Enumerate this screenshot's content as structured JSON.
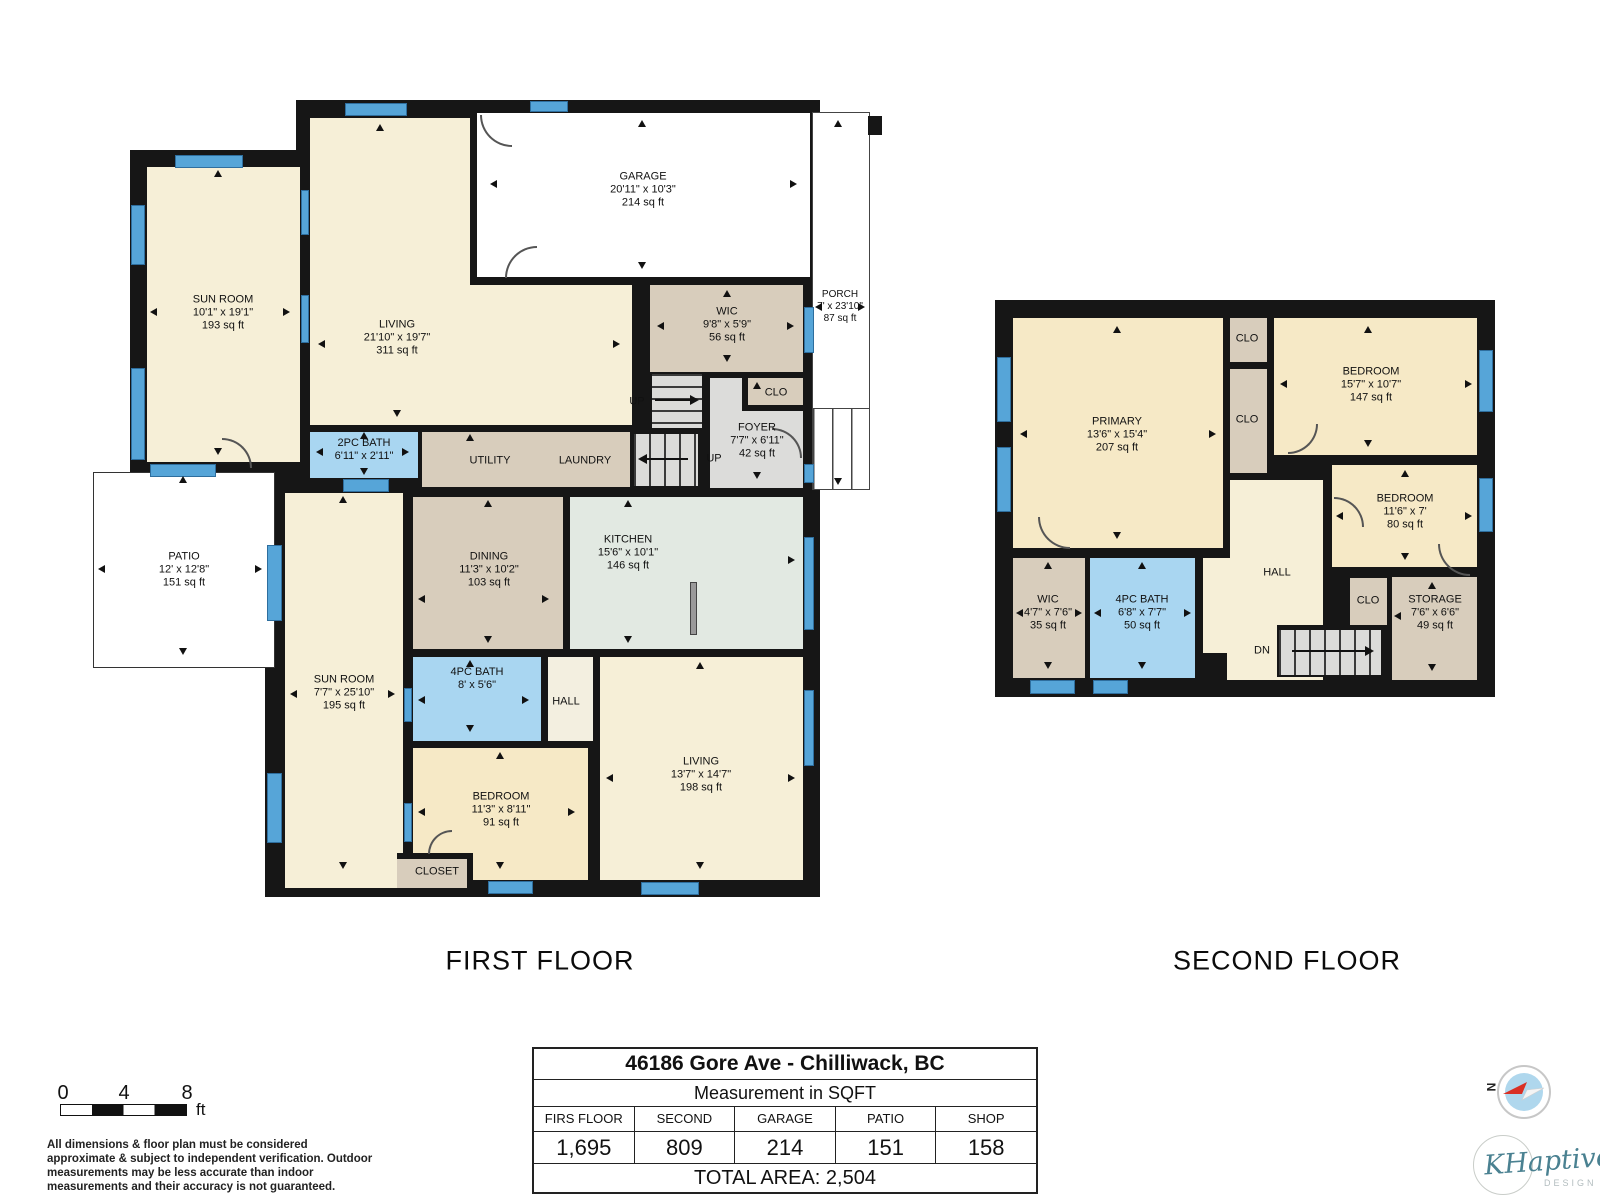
{
  "first_floor": {
    "title": "FIRST FLOOR",
    "rooms": {
      "sunroom1": {
        "name": "SUN ROOM",
        "dims": "10'1\" x 19'1\"",
        "area": "193 sq ft"
      },
      "living": {
        "name": "LIVING",
        "dims": "21'10\" x 19'7\"",
        "area": "311 sq ft"
      },
      "garage": {
        "name": "GARAGE",
        "dims": "20'11\" x 10'3\"",
        "area": "214 sq ft"
      },
      "wic": {
        "name": "WIC",
        "dims": "9'8\" x 5'9\"",
        "area": "56 sq ft"
      },
      "porch": {
        "name": "PORCH",
        "dims": "7' x 23'10\"",
        "area": "87 sq ft"
      },
      "clo": "CLO",
      "foyer": {
        "name": "FOYER",
        "dims": "7'7\" x 6'11\"",
        "area": "42 sq ft"
      },
      "bath2pc": {
        "name": "2PC BATH",
        "dims": "6'11\" x 2'11\""
      },
      "utility": "UTILITY",
      "laundry": "LAUNDRY",
      "up1": "UP",
      "up2": "UP",
      "patio": {
        "name": "PATIO",
        "dims": "12' x 12'8\"",
        "area": "151 sq ft"
      },
      "sunroom2": {
        "name": "SUN ROOM",
        "dims": "7'7\" x 25'10\"",
        "area": "195 sq ft"
      },
      "dining": {
        "name": "DINING",
        "dims": "11'3\" x 10'2\"",
        "area": "103 sq ft"
      },
      "kitchen": {
        "name": "KITCHEN",
        "dims": "15'6\" x 10'1\"",
        "area": "146 sq ft"
      },
      "bath4pc": {
        "name": "4PC BATH",
        "dims": "8' x 5'6\""
      },
      "hall": "HALL",
      "bedroom": {
        "name": "BEDROOM",
        "dims": "11'3\" x 8'11\"",
        "area": "91 sq ft"
      },
      "closet": "CLOSET",
      "living2": {
        "name": "LIVING",
        "dims": "13'7\" x 14'7\"",
        "area": "198 sq ft"
      }
    }
  },
  "second_floor": {
    "title": "SECOND FLOOR",
    "rooms": {
      "primary": {
        "name": "PRIMARY",
        "dims": "13'6\" x 15'4\"",
        "area": "207 sq ft"
      },
      "clo_top": "CLO",
      "clo_mid": "CLO",
      "bedroom_tr": {
        "name": "BEDROOM",
        "dims": "15'7\" x 10'7\"",
        "area": "147 sq ft"
      },
      "bedroom_r": {
        "name": "BEDROOM",
        "dims": "11'6\" x 7'",
        "area": "80 sq ft"
      },
      "hall": "HALL",
      "wic": {
        "name": "WIC",
        "dims": "4'7\" x 7'6\"",
        "area": "35 sq ft"
      },
      "bath4pc": {
        "name": "4PC BATH",
        "dims": "6'8\" x 7'7\"",
        "area": "50 sq ft"
      },
      "clo": "CLO",
      "storage": {
        "name": "STORAGE",
        "dims": "7'6\" x 6'6\"",
        "area": "49 sq ft"
      },
      "dn": "DN"
    }
  },
  "summary_table": {
    "title": "46186 Gore Ave - Chilliwack, BC",
    "subtitle": "Measurement in SQFT",
    "headers": [
      "FIRS FLOOR",
      "SECOND FLOOR",
      "GARAGE",
      "PATIO",
      "SHOP"
    ],
    "values": [
      "1,695",
      "809",
      "214",
      "151",
      "158"
    ],
    "total": "TOTAL AREA: 2,504"
  },
  "scale_bar": {
    "ticks": [
      "0",
      "4",
      "8"
    ],
    "unit": "ft"
  },
  "disclaimer": "All dimensions & floor plan must be considered approximate & subject to independent verification.  Outdoor measurements may be less accurate than indoor measurements and their accuracy is not guaranteed.",
  "compass": {
    "north_label": "N"
  },
  "logo": {
    "name": "KHaptive",
    "subtitle": "DESIGN"
  },
  "colors": {
    "wall": "#161616",
    "window": "#56A5D8",
    "bath": "#A9D6F1",
    "kitchen": "#E2E9E2",
    "tan": "#D8CDBC",
    "cream": "#F6EFD7",
    "cream_warm": "#F6E9C6",
    "gray": "#DCDCDA"
  }
}
